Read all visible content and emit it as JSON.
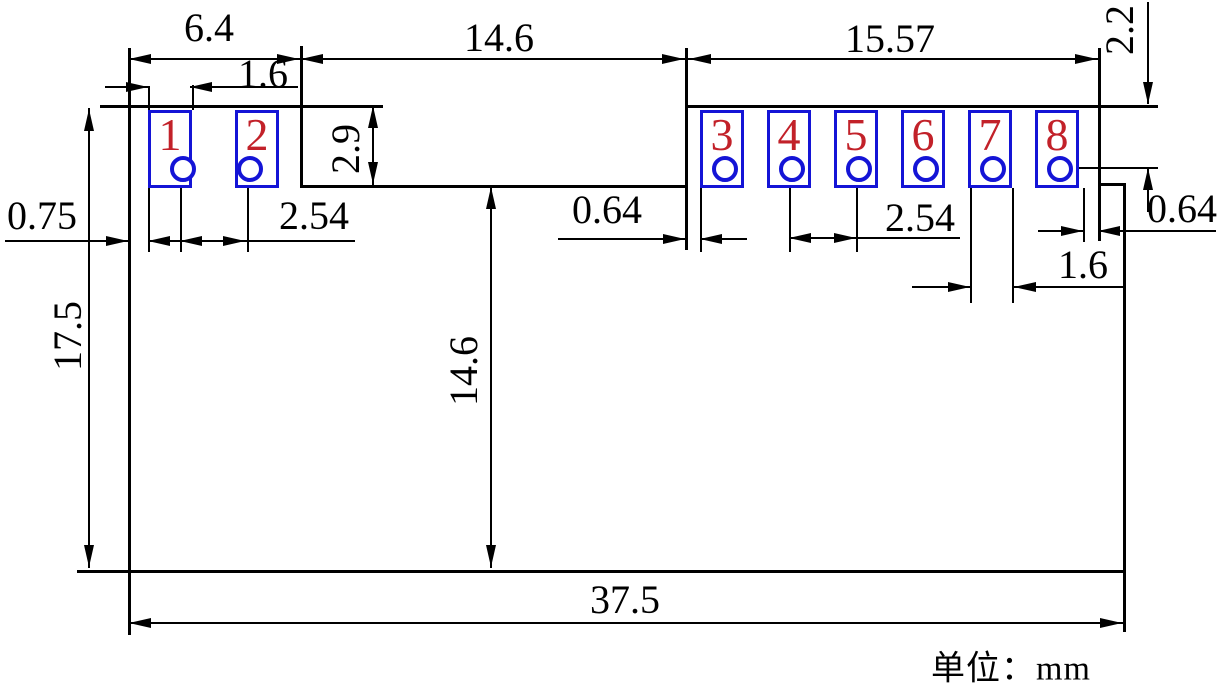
{
  "title": "PCB module footprint dimension drawing",
  "unit_label": "单位：mm",
  "colors": {
    "background": "#ffffff",
    "outline": "#000000",
    "pad_outline": "#1414d6",
    "hole_outline": "#1414d6",
    "pad_number": "#c22129"
  },
  "pads": [
    {
      "number": "1",
      "x": 148,
      "hole_x": 180
    },
    {
      "number": "2",
      "x": 235,
      "hole_x": 247
    },
    {
      "number": "3",
      "x": 700,
      "hole_x": 722
    },
    {
      "number": "4",
      "x": 767,
      "hole_x": 789
    },
    {
      "number": "5",
      "x": 834,
      "hole_x": 856
    },
    {
      "number": "6",
      "x": 901,
      "hole_x": 923
    },
    {
      "number": "7",
      "x": 968,
      "hole_x": 990
    },
    {
      "number": "8",
      "x": 1035,
      "hole_x": 1057
    }
  ],
  "measurements": [
    {
      "id": "top-left-width",
      "label": "6.4",
      "orientation": "horizontal"
    },
    {
      "id": "top-center-width",
      "label": "14.6",
      "orientation": "horizontal"
    },
    {
      "id": "top-right-width",
      "label": "15.57",
      "orientation": "horizontal"
    },
    {
      "id": "edge-to-hole-height",
      "label": "2.2",
      "orientation": "vertical"
    },
    {
      "id": "pad1-width",
      "label": "1.6",
      "orientation": "horizontal"
    },
    {
      "id": "notch-depth",
      "label": "2.9",
      "orientation": "vertical"
    },
    {
      "id": "edge-to-pad1-gap",
      "label": "0.75",
      "orientation": "horizontal"
    },
    {
      "id": "hole-pitch-left",
      "label": "2.54",
      "orientation": "horizontal"
    },
    {
      "id": "edge-to-pad3-gap",
      "label": "0.64",
      "orientation": "horizontal"
    },
    {
      "id": "hole-pitch-right",
      "label": "2.54",
      "orientation": "horizontal"
    },
    {
      "id": "pad8-edge-gap",
      "label": "0.64",
      "orientation": "horizontal"
    },
    {
      "id": "pad7-width",
      "label": "1.6",
      "orientation": "horizontal"
    },
    {
      "id": "body-height",
      "label": "17.5",
      "orientation": "vertical"
    },
    {
      "id": "notch-to-bottom",
      "label": "14.6",
      "orientation": "vertical"
    },
    {
      "id": "body-width",
      "label": "37.5",
      "orientation": "horizontal"
    }
  ],
  "drawing": {
    "pad_geometry": {
      "top_y": 110,
      "width": 44,
      "height": 78,
      "hole_center_y": 166,
      "hole_diameter": 26
    },
    "lines": [
      [
        100,
        105,
        283,
        "h",
        3
      ],
      [
        685,
        105,
        473,
        "h",
        3
      ],
      [
        128,
        48,
        587,
        "v",
        3
      ],
      [
        300,
        46,
        139,
        "v",
        3
      ],
      [
        300,
        185,
        385,
        "h",
        3
      ],
      [
        685,
        48,
        202,
        "v",
        3
      ],
      [
        1098,
        48,
        193,
        "v",
        3
      ],
      [
        1098,
        183,
        25,
        "h",
        3
      ],
      [
        1123,
        183,
        449,
        "v",
        3
      ],
      [
        77,
        570,
        1046,
        "h",
        3
      ],
      [
        1057,
        167,
        101,
        "h",
        2
      ],
      [
        148,
        86,
        24,
        "v",
        2
      ],
      [
        192,
        85,
        25,
        "v",
        2
      ],
      [
        148,
        188,
        64,
        "v",
        2
      ],
      [
        180,
        166,
        86,
        "v",
        2
      ],
      [
        247,
        166,
        86,
        "v",
        2
      ],
      [
        700,
        188,
        64,
        "v",
        2
      ],
      [
        789,
        166,
        86,
        "v",
        2
      ],
      [
        856,
        166,
        86,
        "v",
        2
      ],
      [
        970,
        188,
        115,
        "v",
        2
      ],
      [
        1012,
        188,
        115,
        "v",
        2
      ],
      [
        1083,
        188,
        54,
        "v",
        2
      ],
      [
        128,
        58,
        970,
        "h",
        2
      ],
      [
        1147,
        2,
        102,
        "v",
        2
      ],
      [
        105,
        86,
        43,
        "h",
        2
      ],
      [
        190,
        86,
        108,
        "h",
        2
      ],
      [
        372,
        105,
        80,
        "v",
        2
      ],
      [
        5,
        240,
        123,
        "h",
        2
      ],
      [
        148,
        240,
        207,
        "h",
        2
      ],
      [
        558,
        238,
        127,
        "h",
        2
      ],
      [
        700,
        238,
        47,
        "h",
        2
      ],
      [
        789,
        237,
        171,
        "h",
        2
      ],
      [
        1038,
        230,
        45,
        "h",
        2
      ],
      [
        1098,
        230,
        118,
        "h",
        2
      ],
      [
        912,
        286,
        58,
        "h",
        2
      ],
      [
        1014,
        286,
        109,
        "h",
        2
      ],
      [
        1147,
        168,
        44,
        "v",
        2
      ],
      [
        88,
        108,
        460,
        "v",
        2
      ],
      [
        490,
        186,
        382,
        "v",
        2
      ],
      [
        128,
        622,
        995,
        "h",
        2
      ]
    ],
    "arrows": [
      [
        129,
        58,
        "left"
      ],
      [
        299,
        58,
        "right"
      ],
      [
        301,
        58,
        "left"
      ],
      [
        684,
        58,
        "right"
      ],
      [
        689,
        58,
        "left"
      ],
      [
        1097,
        58,
        "right"
      ],
      [
        1147,
        104,
        "down"
      ],
      [
        148,
        86,
        "right"
      ],
      [
        190,
        86,
        "left"
      ],
      [
        372,
        106,
        "up"
      ],
      [
        372,
        184,
        "down"
      ],
      [
        128,
        240,
        "right"
      ],
      [
        148,
        240,
        "left"
      ],
      [
        180,
        240,
        "left"
      ],
      [
        245,
        240,
        "right"
      ],
      [
        685,
        238,
        "right"
      ],
      [
        700,
        238,
        "left"
      ],
      [
        789,
        237,
        "left"
      ],
      [
        856,
        237,
        "right"
      ],
      [
        1083,
        230,
        "right"
      ],
      [
        1098,
        230,
        "left"
      ],
      [
        970,
        286,
        "right"
      ],
      [
        1014,
        286,
        "left"
      ],
      [
        1147,
        168,
        "up"
      ],
      [
        88,
        109,
        "up"
      ],
      [
        88,
        567,
        "down"
      ],
      [
        490,
        187,
        "up"
      ],
      [
        490,
        567,
        "down"
      ],
      [
        129,
        622,
        "left"
      ],
      [
        1122,
        622,
        "right"
      ]
    ]
  }
}
